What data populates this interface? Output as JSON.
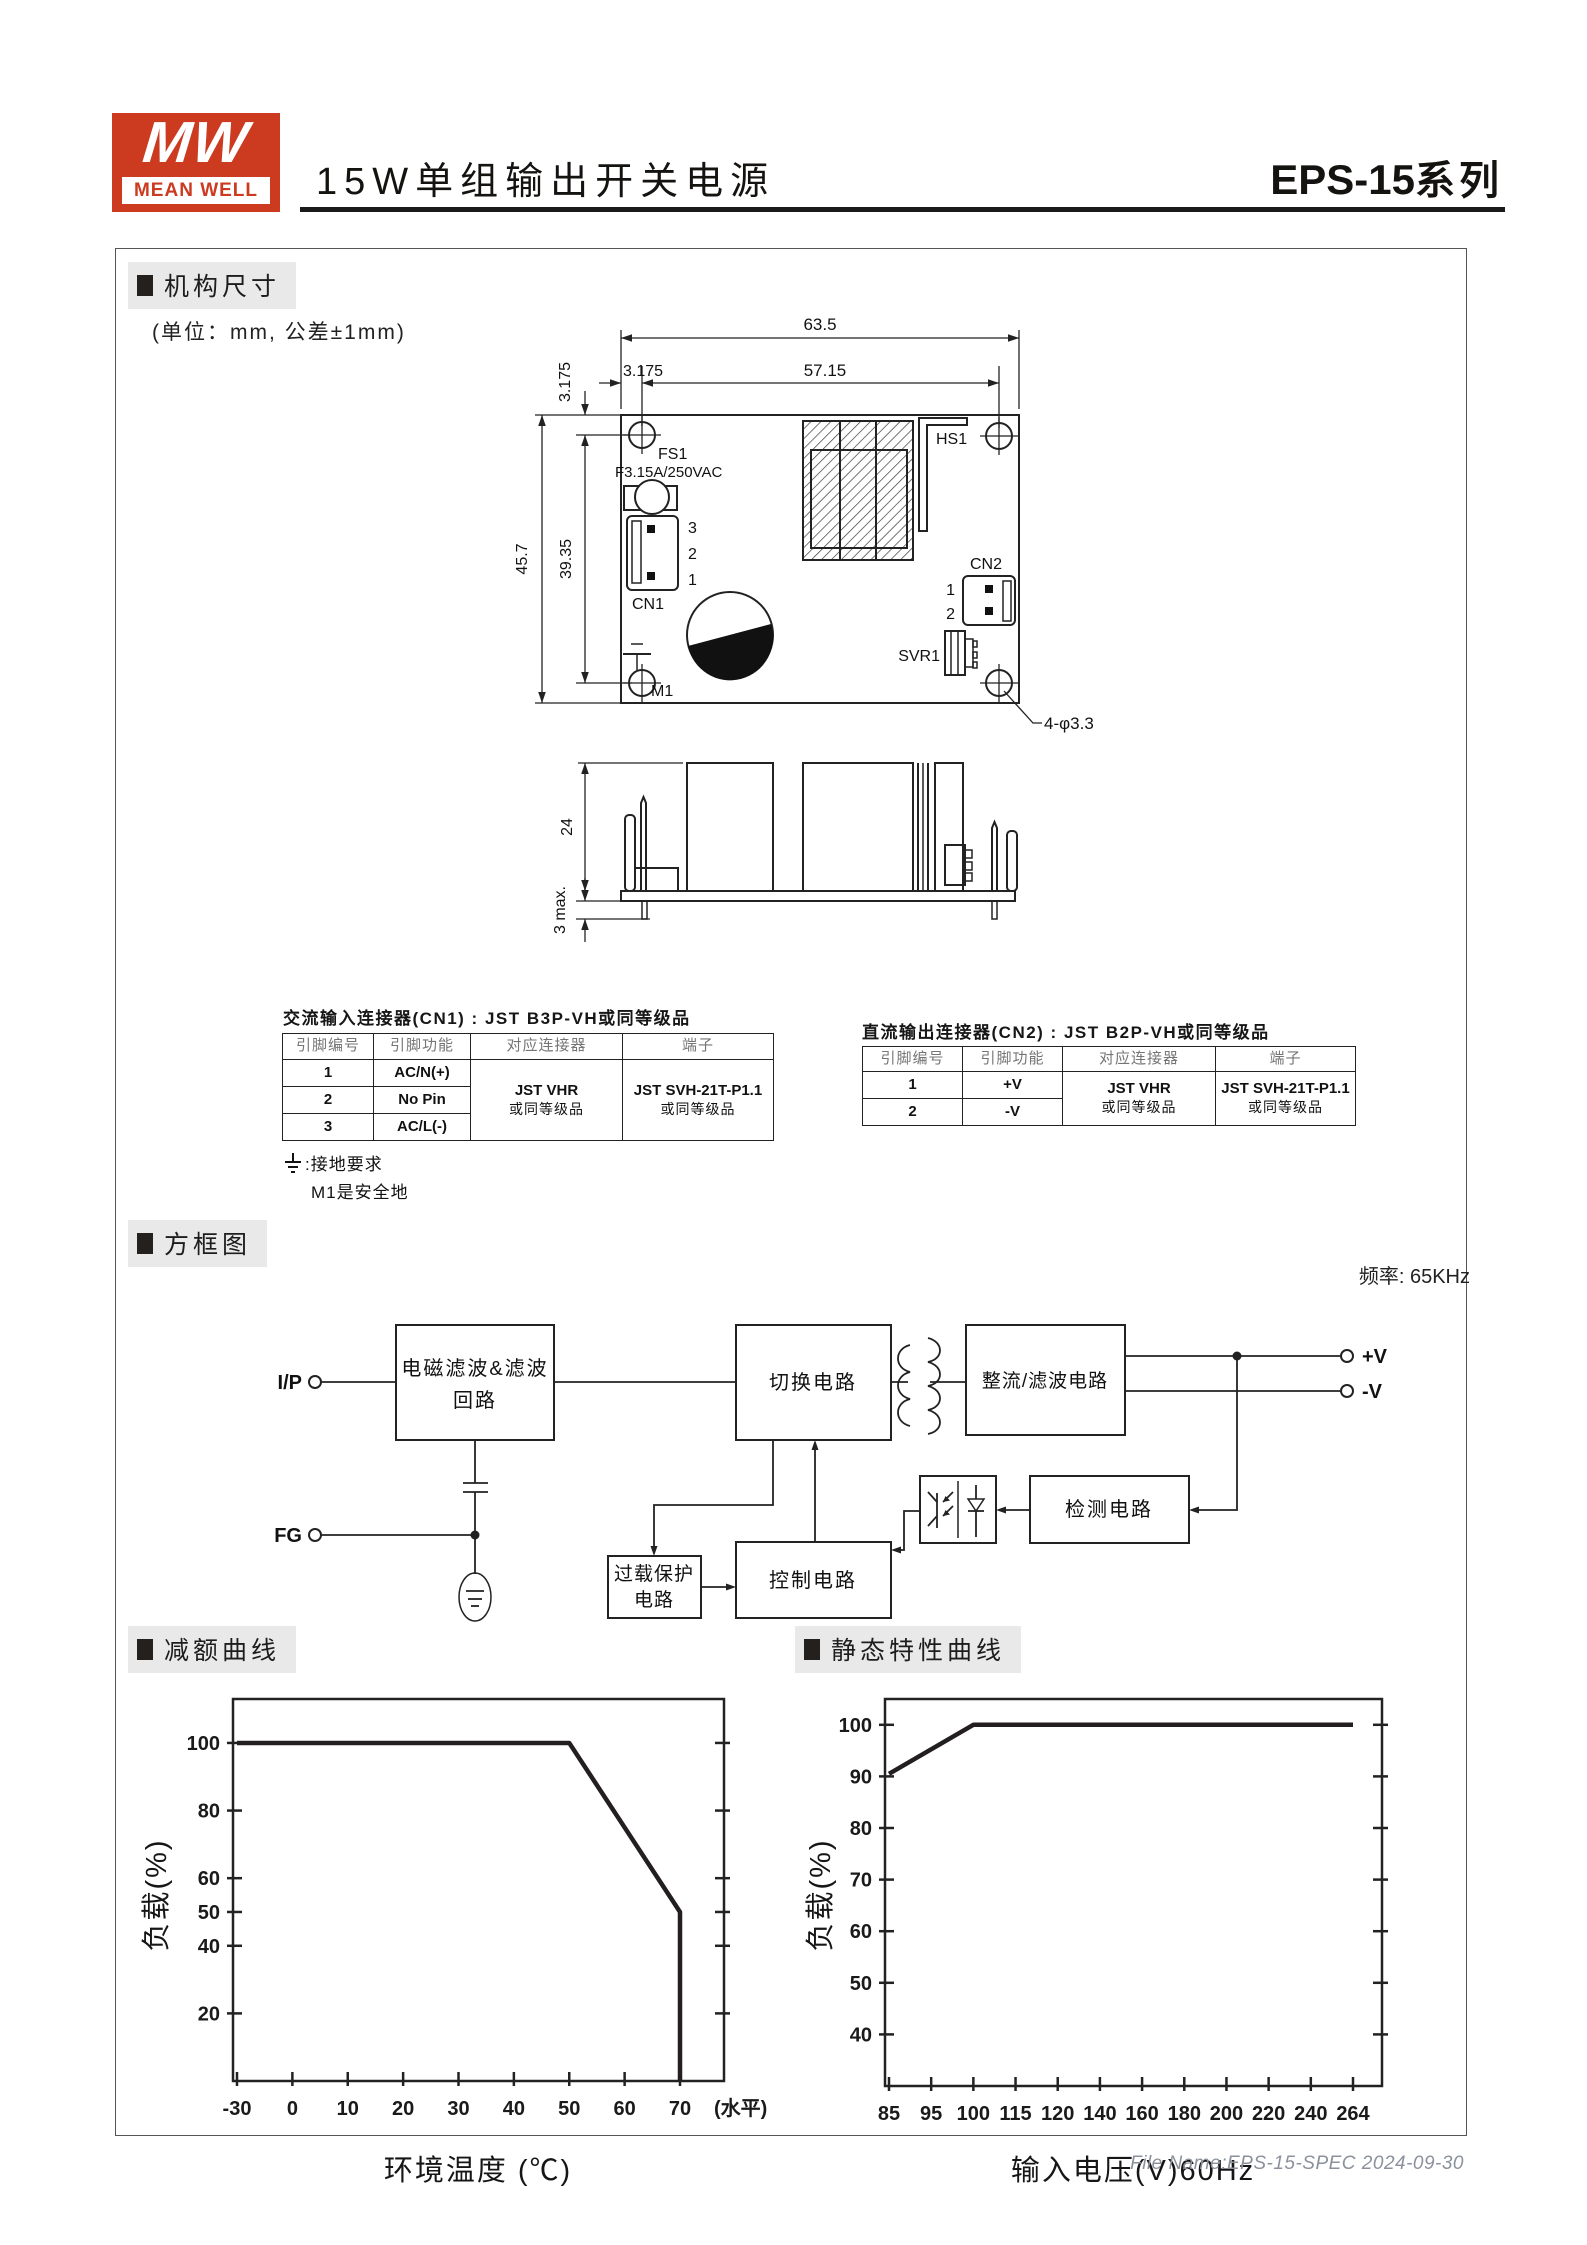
{
  "header": {
    "logo_mw": "MW",
    "logo_brand": "MEAN WELL",
    "brand_color": "#cc3a20",
    "title": "15W单组输出开关电源",
    "series": "EPS-15",
    "series_suffix": "系列"
  },
  "mech": {
    "section_title": "机构尺寸",
    "unit_note": "(单位：mm, 公差±1mm)",
    "dims": {
      "board_width": "63.5",
      "hole_span_h": "57.15",
      "offset_h": "3.175",
      "offset_v": "3.175",
      "board_height": "45.7",
      "hole_span_v": "39.35",
      "side_height": "24",
      "pin_protrusion": "3 max.",
      "holes_note": "4-φ3.3"
    },
    "labels": {
      "fs1": "FS1",
      "fuse_rating": "F3.15A/250VAC",
      "hs1": "HS1",
      "cn1": "CN1",
      "cn2": "CN2",
      "svr1": "SVR1",
      "m1": "M1",
      "cn1_pins": [
        "3",
        "2",
        "1"
      ],
      "cn2_pins": [
        "1",
        "2"
      ]
    }
  },
  "cn1_table": {
    "title": "交流输入连接器(CN1) : JST B3P-VH或同等级品",
    "headers": [
      "引脚编号",
      "引脚功能",
      "对应连接器",
      "端子"
    ],
    "rows": [
      [
        "1",
        "AC/N(+)"
      ],
      [
        "2",
        "No Pin"
      ],
      [
        "3",
        "AC/L(-)"
      ]
    ],
    "mating": [
      "JST VHR",
      "或同等级品"
    ],
    "terminal": [
      "JST SVH-21T-P1.1",
      "或同等级品"
    ]
  },
  "ground_note": {
    "line1": ":接地要求",
    "line2": "M1是安全地"
  },
  "cn2_table": {
    "title": "直流输出连接器(CN2) : JST B2P-VH或同等级品",
    "headers": [
      "引脚编号",
      "引脚功能",
      "对应连接器",
      "端子"
    ],
    "rows": [
      [
        "1",
        "+V"
      ],
      [
        "2",
        "-V"
      ]
    ],
    "mating": [
      "JST VHR",
      "或同等级品"
    ],
    "terminal": [
      "JST SVH-21T-P1.1",
      "或同等级品"
    ]
  },
  "block": {
    "section_title": "方框图",
    "frequency": "频率: 65KHz",
    "io": {
      "input": "I/P",
      "fg": "FG",
      "vplus": "+V",
      "vminus": "-V"
    },
    "blocks": {
      "emi_line1": "电磁滤波&滤波",
      "emi_line2": "回路",
      "switch": "切换电路",
      "rectifier": "整流/滤波电路",
      "overload_line1": "过载保护",
      "overload_line2": "电路",
      "control": "控制电路",
      "detect": "检测电路"
    }
  },
  "chart_data": [
    {
      "id": "derating",
      "type": "line",
      "title": "减额曲线",
      "xlabel": "环境温度 (℃)",
      "ylabel": "负载(%)",
      "x_tick_labels": [
        "-30",
        "0",
        "10",
        "20",
        "30",
        "40",
        "50",
        "60",
        "70"
      ],
      "x_suffix": "(水平)",
      "y_ticks": [
        20,
        40,
        50,
        60,
        80,
        100
      ],
      "ylim": [
        0,
        113
      ],
      "grid": false,
      "legend": false,
      "points": [
        [
          -30,
          100
        ],
        [
          50,
          100
        ],
        [
          70,
          50
        ],
        [
          70,
          0
        ]
      ]
    },
    {
      "id": "static",
      "type": "line",
      "title": "静态特性曲线",
      "xlabel": "输入电压(V)60Hz",
      "ylabel": "负载(%)",
      "x_tick_labels": [
        "85",
        "95",
        "100",
        "115",
        "120",
        "140",
        "160",
        "180",
        "200",
        "220",
        "240",
        "264"
      ],
      "y_ticks": [
        40,
        50,
        60,
        70,
        80,
        90,
        100
      ],
      "ylim": [
        30,
        105
      ],
      "grid": false,
      "legend": false,
      "points": [
        [
          85,
          90.5
        ],
        [
          100,
          100
        ],
        [
          264,
          100
        ]
      ]
    }
  ],
  "footer": {
    "text": "File Name:EPS-15-SPEC  2024-09-30"
  }
}
